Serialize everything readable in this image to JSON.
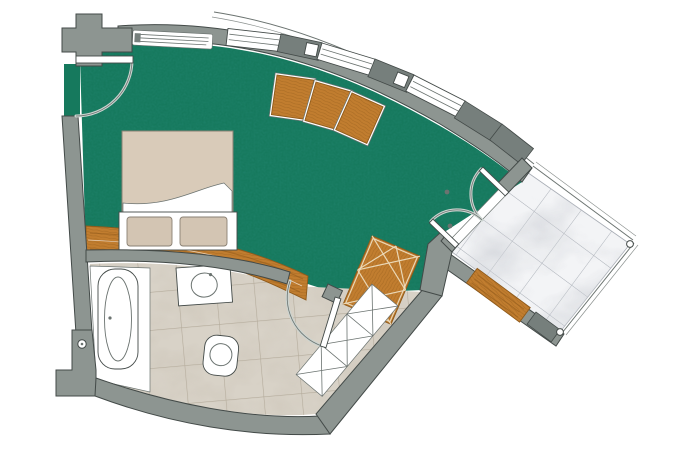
{
  "meta": {
    "type": "architectural-floor-plan",
    "description": "Fan-shaped hotel room floor plan: green carpeted bedroom with double bed, curved window wall, stone-tiled bathroom with bathtub, washbasin and toilet, and a marble-tiled triangular terrace reached through double french doors"
  },
  "colors": {
    "background": "#ffffff",
    "wall": "#8d9591",
    "wall_dark": "#767f7c",
    "outline": "#434a48",
    "carpet": "#16795d",
    "carpet_speckle": "#073f2f",
    "wood": "#c17d2f",
    "wood_dark": "#8f5a1a",
    "wood_light": "#e2b06b",
    "duvet": "#d9cbb9",
    "pillow": "#d3c5b3",
    "white": "#ffffff",
    "tile": "#d8d2c7",
    "tile_grid": "#b3aa9a",
    "marble": "#f3f4f6",
    "marble_grid": "#a8adb5",
    "arc": "#ccd4d0",
    "line": "#6b7370"
  },
  "rooms": [
    {
      "id": "bedroom",
      "floor": "green-carpet"
    },
    {
      "id": "bathroom",
      "floor": "stone-tile"
    },
    {
      "id": "terrace",
      "floor": "marble-tile"
    }
  ],
  "windows": {
    "count": 3,
    "style": "curved-window-band"
  },
  "furniture": [
    {
      "id": "double-bed",
      "pillows": 2
    },
    {
      "id": "headboard-wood-panel"
    },
    {
      "id": "wood-sideboard",
      "sections": 3
    },
    {
      "id": "lattice-wardrobe"
    },
    {
      "id": "closet-row",
      "sections": 3
    }
  ],
  "fixtures": [
    {
      "id": "bathtub"
    },
    {
      "id": "washbasin"
    },
    {
      "id": "toilet"
    }
  ],
  "openings": [
    {
      "id": "entry-door"
    },
    {
      "id": "bathroom-door"
    },
    {
      "id": "terrace-french-door",
      "leaves": 2
    },
    {
      "id": "terrace-wood-door"
    }
  ]
}
